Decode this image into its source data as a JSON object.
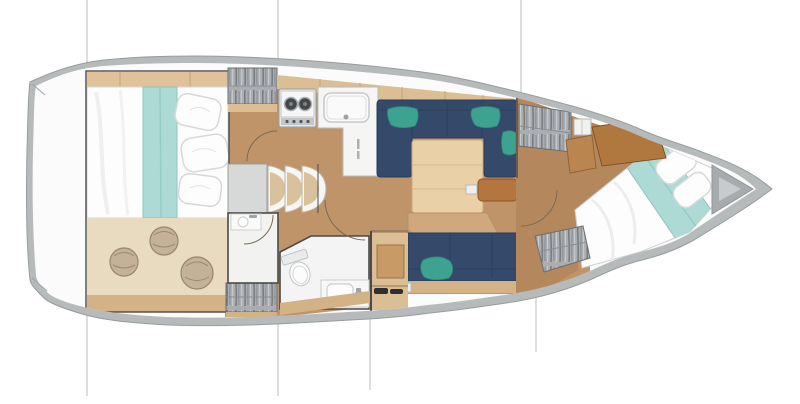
{
  "canvas": {
    "width": 800,
    "height": 404,
    "background": "#ffffff"
  },
  "colors": {
    "hull_rim": "#b7babb",
    "hull_edge": "#9a9e a0",
    "deck_white": "#fbfbfb",
    "floor": "#bf9469",
    "floor_light": "#cfa87e",
    "floor_fwd": "#b4875d",
    "rug": "#e9dbc0",
    "wood": "#dcbe94",
    "wood_trim": "#d3b285",
    "headboard": "#dfc29a",
    "table": "#e9d0a6",
    "navy": "#35496b",
    "navy_dark": "#273a58",
    "teal": "#3ea291",
    "bed_teal": "#aedad5",
    "bed_white": "#fdfdfd",
    "ward_bg": "#aaaeb1",
    "counter": "#f5f5f4",
    "fixture": "#9ea3a6",
    "landing": "#d7d8d8",
    "step_white": "#f7f6f2",
    "step_wood": "#d9c19c",
    "bow_gray": "#a7abad",
    "bow_gray_light": "#c8cbcc",
    "wall": "#4a4a4a",
    "door": "#7a6a58",
    "line": "#bcbcbc",
    "ottoman": "#b5753f",
    "desk": "#b0783f",
    "dark_item": "#2f2f2f",
    "pouf": "#c3b198",
    "pouf_dark": "#96866e"
  },
  "plan": {
    "type": "yacht-interior-floorplan",
    "orientation": "bow-right",
    "rooms": [
      {
        "name": "aft-cabin",
        "features": [
          "double-bed",
          "teal-runner",
          "pillows",
          "rug",
          "3-poufs",
          "wardrobe"
        ]
      },
      {
        "name": "galley",
        "features": [
          "2-burner-stove",
          "sink",
          "fridge",
          "overhead-lockers"
        ]
      },
      {
        "name": "salon",
        "features": [
          "u-settee",
          "3-teal-cushions",
          "dining-table",
          "leather-ottoman",
          "straight-settee",
          "green-cushion"
        ]
      },
      {
        "name": "head",
        "features": [
          "toilet",
          "washbasin",
          "shower-compartment",
          "wardrobe"
        ]
      },
      {
        "name": "forward-cabin",
        "features": [
          "island-bed",
          "teal-runner",
          "pillows",
          "2-wardrobes",
          "vanity-panel"
        ]
      },
      {
        "name": "companionway",
        "features": [
          "3-curved-steps",
          "landing"
        ]
      }
    ],
    "counts": {
      "burners": 2,
      "poufs": 3,
      "steps": 3,
      "settee_cushions": 4
    },
    "section_lines_x": [
      87,
      278,
      370,
      521,
      536
    ]
  }
}
